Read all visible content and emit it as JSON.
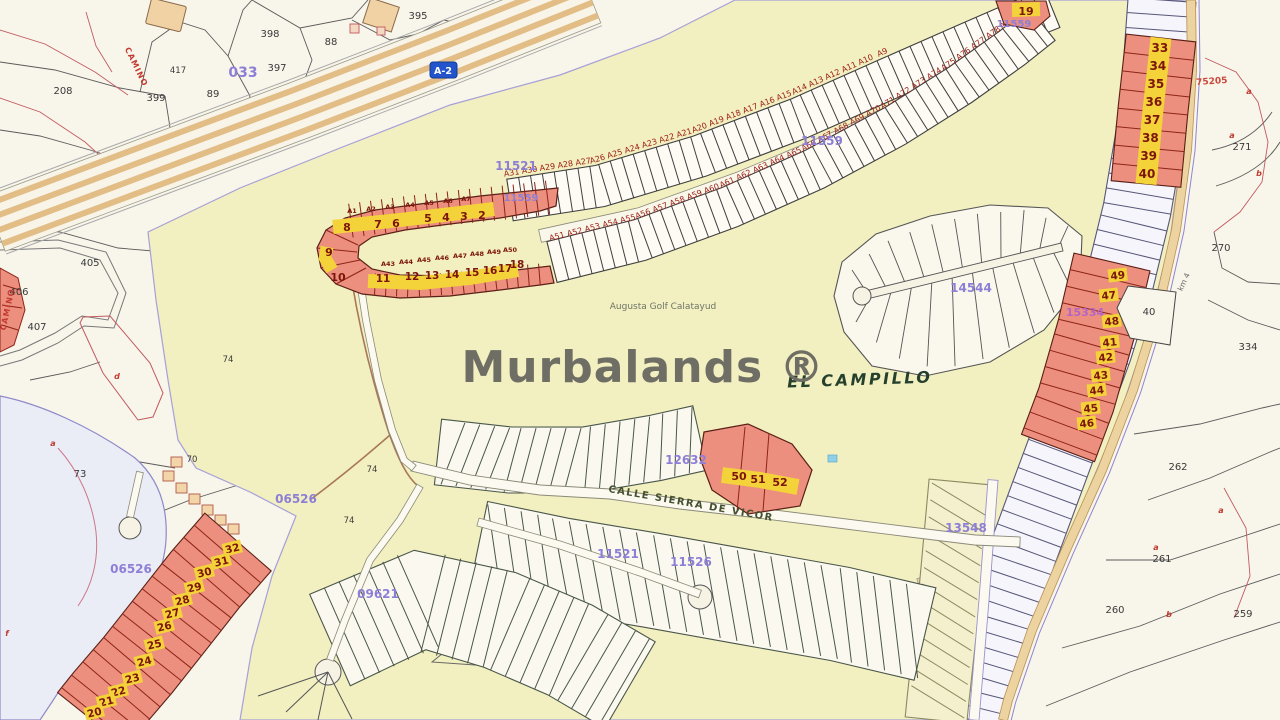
{
  "watermark": {
    "text": "Murbalands ®"
  },
  "map_labels": {
    "area_name": "EL CAMPILLO",
    "golf_course": "Augusta Golf Calatayud",
    "street": "CALLE SIERRA DE VICOR",
    "highway_sign": "A-2",
    "camino_top": "CAMINO",
    "camino_left": "CAMINO",
    "km_marker": "km 4"
  },
  "zone_codes": {
    "z11521_top": "11521",
    "z11559_left": "11559",
    "z11559_mid": "11559",
    "z11559_plot19": "11559",
    "z14544": "14544",
    "z12632": "12632",
    "z11521_bottom": "11521",
    "z11526": "11526",
    "z09621": "09621",
    "z13548": "13548",
    "z06526_upper": "06526",
    "z06526_lower": "06526",
    "z033": "033",
    "z15334": "15334",
    "z75205": "75205"
  },
  "parcel_numbers": {
    "n208": "208",
    "n398": "398",
    "n397": "397",
    "n399": "399",
    "n89": "89",
    "n417": "417",
    "n88": "88",
    "n395": "395",
    "n405": "405",
    "n406": "406",
    "n407": "407",
    "n74a": "74",
    "n74b": "74",
    "n74c": "74",
    "n70": "70",
    "n73": "73",
    "n270": "270",
    "n271": "271",
    "n334": "334",
    "n262": "262",
    "n261": "261",
    "n260": "260",
    "n259": "259",
    "n40": "40"
  },
  "red_letters": {
    "a_mid": "a",
    "d_mid": "d",
    "f_left": "f",
    "a_r1": "a",
    "a_r2": "a",
    "b_r1": "b",
    "a_r3": "a",
    "b_r2": "b",
    "a_r4": "a"
  },
  "highlighted_plots": {
    "hook_top": [
      "8",
      "7",
      "6",
      "5",
      "4",
      "3",
      "2"
    ],
    "hook_bend": [
      "9",
      "10"
    ],
    "hook_bottom": [
      "11",
      "12",
      "13",
      "14",
      "15",
      "16",
      "17",
      "18"
    ],
    "plot_19": "19",
    "right_upper": [
      "33",
      "34",
      "35",
      "36",
      "37",
      "38",
      "39",
      "40"
    ],
    "right_lower": [
      "49",
      "47",
      "48",
      "41",
      "42",
      "43",
      "44",
      "45",
      "46"
    ],
    "southwest": [
      "32",
      "31",
      "30",
      "29",
      "28",
      "27",
      "26",
      "25",
      "24",
      "23",
      "22",
      "21",
      "20"
    ],
    "central": [
      "50",
      "51",
      "52"
    ]
  },
  "strip_labels": {
    "band_upper": [
      "A31",
      "A30",
      "A29",
      "A28",
      "A27",
      "A26",
      "A25",
      "A24",
      "A23",
      "A22",
      "A21",
      "A20",
      "A19",
      "A18",
      "A17",
      "A16",
      "A15",
      "A14",
      "A13",
      "A12",
      "A11",
      "A10",
      "A9"
    ],
    "band_lower": [
      "A51",
      "A52",
      "A53",
      "A54",
      "A55",
      "A56",
      "A57",
      "A58",
      "A59",
      "A60",
      "A61",
      "A62",
      "A63",
      "A64",
      "A65",
      "A66",
      "A67",
      "A68",
      "A69",
      "A70",
      "A71",
      "A72",
      "A73",
      "A74",
      "A75",
      "A76",
      "A77",
      "A78",
      "A79",
      "A80"
    ],
    "hook_top": [
      "A1",
      "A2",
      "A3",
      "A4",
      "A5",
      "A6",
      "A7"
    ],
    "hook_bottom": [
      "A43",
      "A44",
      "A45",
      "A46",
      "A47",
      "A48",
      "A49",
      "A50"
    ]
  },
  "colors": {
    "highlight": "#ec8f7e",
    "chip": "#f3d23a",
    "zone_code": "#8d7fd6",
    "red_label": "#a02018",
    "golf_area": "#f2efc0"
  }
}
